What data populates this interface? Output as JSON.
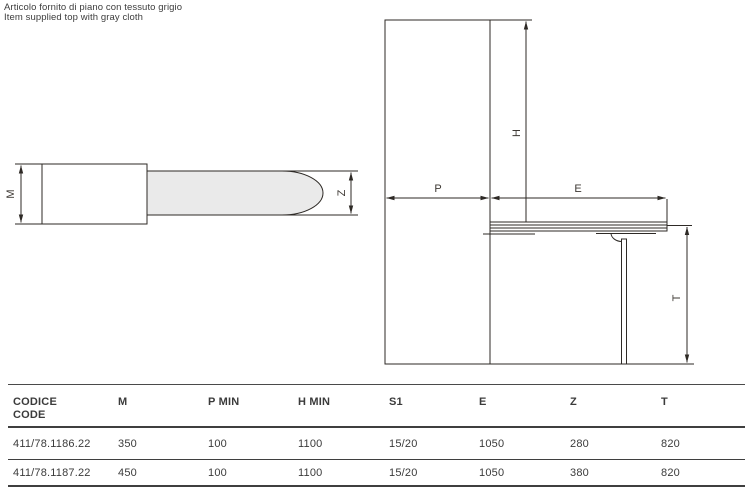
{
  "note": {
    "title": "NOTE",
    "line_it": "Articolo fornito di piano con tessuto grigio",
    "line_en": "Item supplied top with gray cloth"
  },
  "drawing": {
    "top_view": {
      "dim_m_label": "M",
      "dim_z_label": "Z"
    },
    "side_view": {
      "dim_p_label": "P",
      "dim_e_label": "E",
      "dim_h_label": "H",
      "dim_t_label": "T"
    }
  },
  "colors": {
    "line": "#2e2a26",
    "text": "#3d3d3d",
    "board_fill": "#eaeaea"
  },
  "table": {
    "headers": {
      "codice_line1": "CODICE",
      "codice_line2": "CODE",
      "m": "M",
      "p_min": "P MIN",
      "h_min": "H MIN",
      "s1": "S1",
      "e": "E",
      "z": "Z",
      "t": "T"
    },
    "rows": [
      [
        "411/78.1186.22",
        "350",
        "100",
        "1100",
        "15/20",
        "1050",
        "280",
        "820"
      ],
      [
        "411/78.1187.22",
        "450",
        "100",
        "1100",
        "15/20",
        "1050",
        "380",
        "820"
      ]
    ]
  }
}
